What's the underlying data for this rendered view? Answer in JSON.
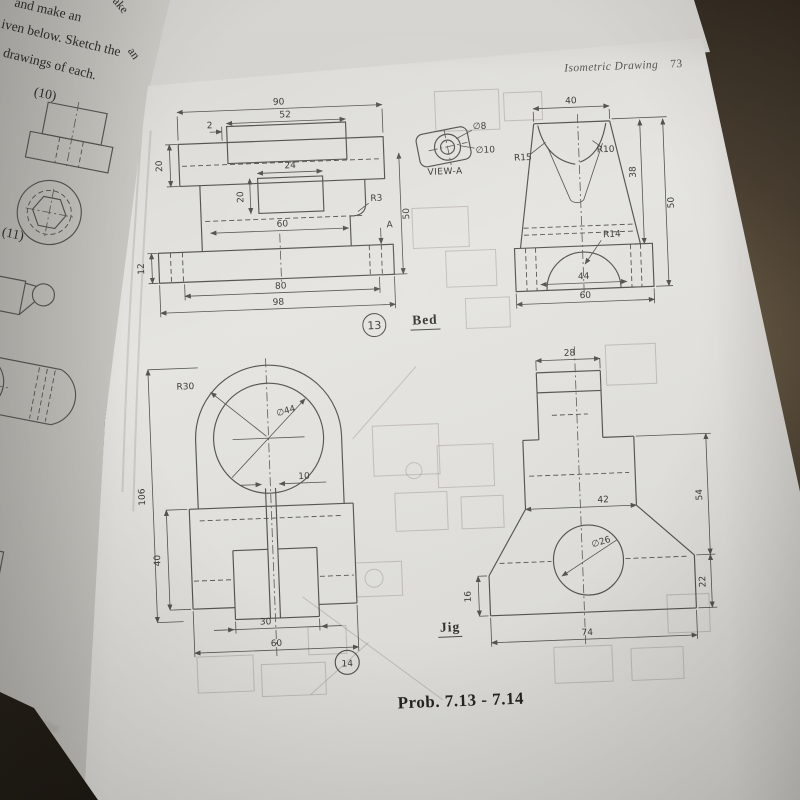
{
  "photo": {
    "header_title": "Isometric Drawing",
    "page_number": "73",
    "caption": "Prob. 7.13 - 7.14"
  },
  "left_page": {
    "line1": "and make an",
    "line2": "iven below. Sketch the",
    "line3": "drawings of each.",
    "item_10": "(10)",
    "item_11": "(11)",
    "edge_fragment_1": "ake",
    "edge_fragment_2": "an",
    "ghost_line_1": "14 The",
    "ghost_line_2": "Be",
    "ghost_line_3": "Co"
  },
  "fig13": {
    "number": "13",
    "title": "Bed",
    "front": {
      "dim_90": "90",
      "dim_52": "52",
      "dim_2": "2",
      "dim_20_slab": "20",
      "dim_24": "24",
      "dim_20_hole": "20",
      "dim_r3": "R3",
      "dim_60": "60",
      "dim_12": "12",
      "dim_80": "80",
      "dim_98": "98",
      "dim_50": "50",
      "view_arrow": "A"
    },
    "view_a": {
      "dim_d8": "∅8",
      "dim_d10": "∅10",
      "label": "VIEW-A"
    },
    "side": {
      "dim_40": "40",
      "dim_r15": "R15",
      "dim_r10": "R10",
      "dim_38": "38",
      "dim_50": "50",
      "dim_r14": "R14",
      "dim_44": "44",
      "dim_60": "60"
    }
  },
  "fig14": {
    "number": "14",
    "title": "Jig",
    "support": {
      "dim_r30": "R30",
      "dim_d44": "∅44",
      "dim_106": "106",
      "dim_10": "10",
      "dim_40": "40",
      "dim_30": "30",
      "dim_60": "60"
    },
    "jig": {
      "dim_28": "28",
      "dim_42": "42",
      "dim_54": "54",
      "dim_d26": "∅26",
      "dim_16": "16",
      "dim_22": "22",
      "dim_74": "74"
    }
  },
  "colors": {
    "table_dark": "#241f19",
    "page_light": "#e4e3df",
    "ink": "#55534f"
  }
}
